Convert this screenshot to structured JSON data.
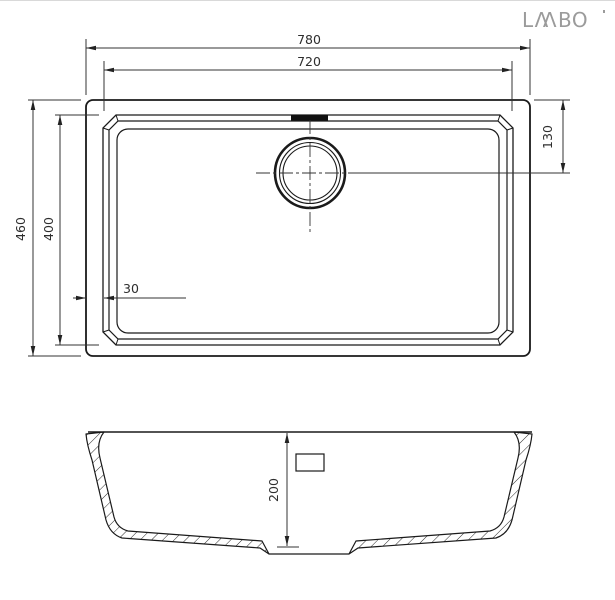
{
  "logo": {
    "brand": "LAVABO",
    "parts": [
      "L",
      "Λ",
      "Λ",
      "BO"
    ],
    "color": "#9b9b9b"
  },
  "dimensions": {
    "outer_width": "780",
    "inner_width": "720",
    "outer_depth": "460",
    "inner_depth": "400",
    "drain_center_from_top": "130",
    "rim_width": "30",
    "bowl_depth": "200"
  },
  "colors": {
    "line": "#1a1a1a",
    "dimension": "#2e2e2e",
    "background": "#ffffff",
    "logo": "#9b9b9b"
  }
}
